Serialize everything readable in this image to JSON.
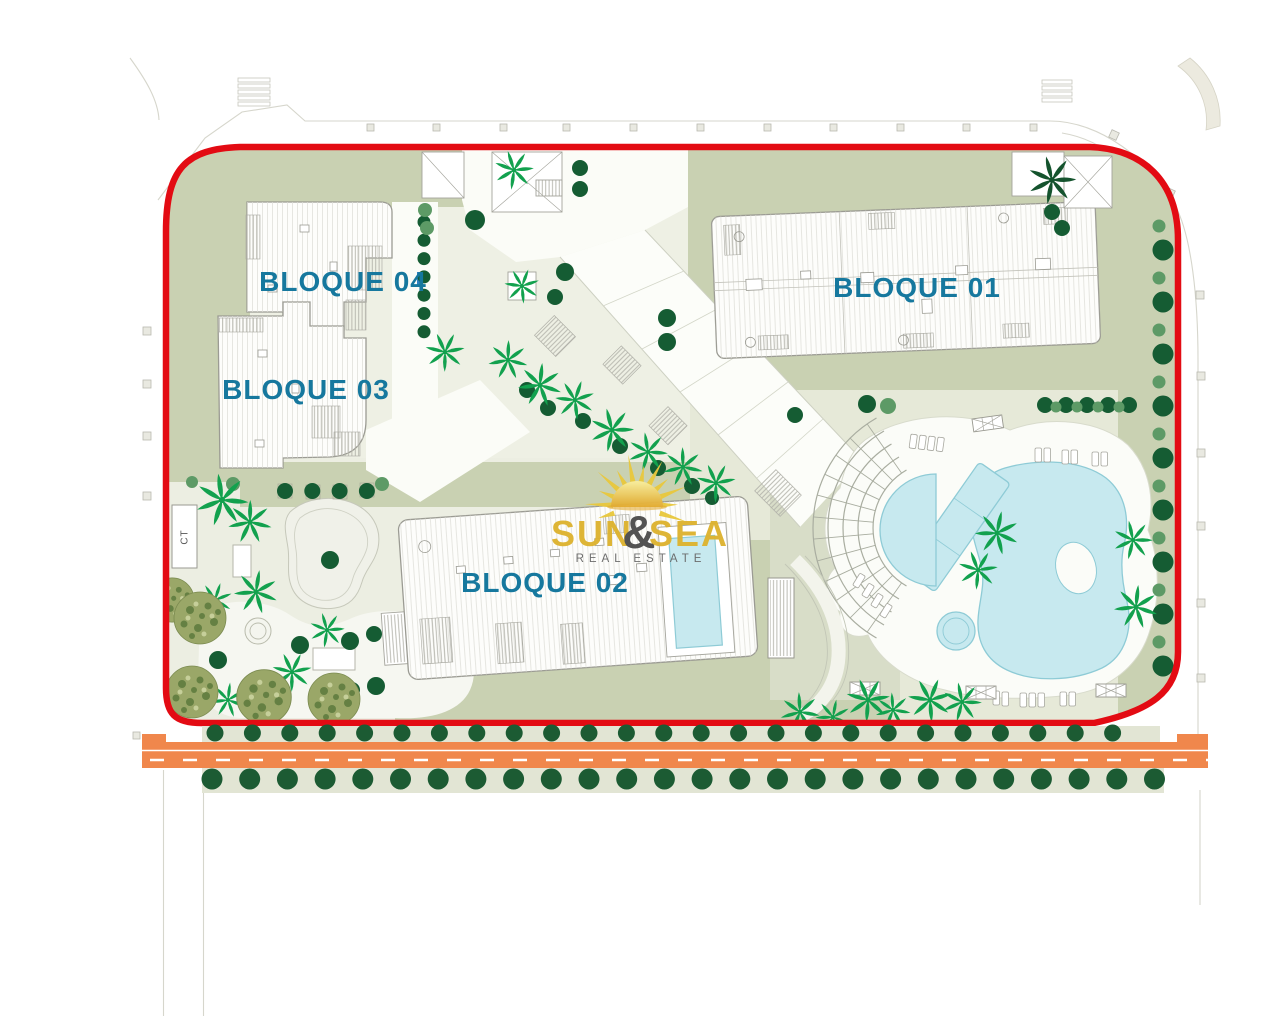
{
  "plan": {
    "type": "architectural-site-plan",
    "background": "#ffffff"
  },
  "labels": {
    "bloque01": "BLOQUE 01",
    "bloque02": "BLOQUE 02",
    "bloque03": "BLOQUE 03",
    "bloque04": "BLOQUE 04",
    "transformer": "CT"
  },
  "logo": {
    "word1": "SUN",
    "ampersand": "&",
    "word2": "SEA",
    "tagline": "REAL ESTATE"
  },
  "colors": {
    "boundary_red": "#e30b13",
    "label_teal": "#16789e",
    "road_orange": "#f0874c",
    "pool_blue": "#c7e9ef",
    "pool_edge": "#8ecbd6",
    "sage_green": "#c9d1b2",
    "pale_green": "#e6e9d8",
    "garden_pale": "#eceee2",
    "tree_dark": "#155c33",
    "tree_light": "#5d9a66",
    "palm_green": "#12a14e",
    "olive_green": "#9aa768",
    "logo_gold": "#ddb32f",
    "logo_gray": "#4d4d4d"
  }
}
